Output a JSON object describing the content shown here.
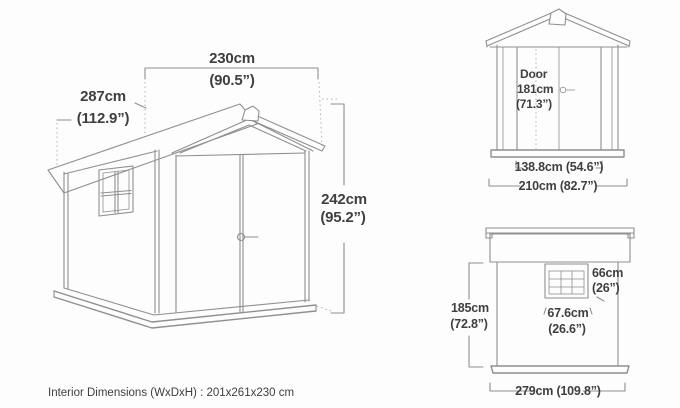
{
  "colors": {
    "background": "#fdfdfd",
    "line": "#8f8f8f",
    "line_soft": "#b3b3b3",
    "text": "#3f3f3f"
  },
  "perspective_view": {
    "width": {
      "metric": "230cm",
      "imperial": "(90.5”)"
    },
    "depth": {
      "metric": "287cm",
      "imperial": "(112.9”)"
    },
    "height": {
      "metric": "242cm",
      "imperial": "(95.2”)"
    }
  },
  "front_view": {
    "door": {
      "title": "Door",
      "metric": "181cm",
      "imperial": "(71.3”)"
    },
    "door_width": "138.8cm (54.6”)",
    "overall_width": "210cm (82.7”)"
  },
  "side_view": {
    "window_height": {
      "metric": "66cm",
      "imperial": "(26”)"
    },
    "window_width": {
      "metric": "67.6cm",
      "imperial": "(26.6”)"
    },
    "wall_height": {
      "metric": "185cm",
      "imperial": "(72.8”)"
    },
    "overall_depth": "279cm (109.8”)"
  },
  "footer": {
    "interior_dimensions": "Interior Dimensions (WxDxH) : 201x261x230 cm"
  }
}
